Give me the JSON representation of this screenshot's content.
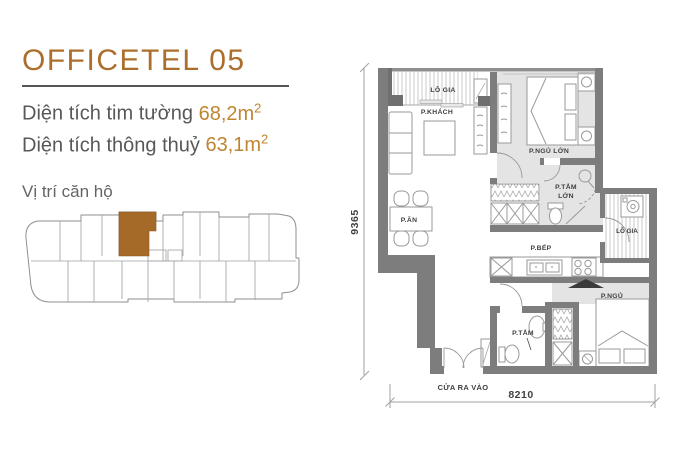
{
  "info": {
    "title": "OFFICETEL 05",
    "line1_label": "Diện tích tim tường",
    "line1_value": "68,2m",
    "line1_sup": "2",
    "line2_label": "Diện tích thông thuỷ",
    "line2_value": "63,1m",
    "line2_sup": "2",
    "location_title": "Vị trí căn hộ"
  },
  "plan": {
    "labels": {
      "balcony_top": "LÔ GIA",
      "living": "P.KHÁCH",
      "master_bedroom": "P.NGỦ LỚN",
      "master_bath_l1": "P.TẮM",
      "master_bath_l2": "LỚN",
      "dining": "P.ĂN",
      "kitchen": "P.BẾP",
      "balcony_right": "LÔ GIA",
      "bedroom2": "P.NGỦ",
      "bath2": "P.TẮM",
      "entrance": "CỬA RA VÀO"
    },
    "dims": {
      "height_mm": "9365",
      "width_mm": "8210"
    }
  },
  "colors": {
    "accent": "#AC6E2B",
    "value_highlight": "#BE8532",
    "body_text": "#57585A",
    "muted_text": "#636466",
    "wall": "#7D7D7D",
    "wall_dark": "#6F6F6F",
    "floor_shade": "#E4E4E4",
    "keyplan_highlight": "#A66A28"
  }
}
